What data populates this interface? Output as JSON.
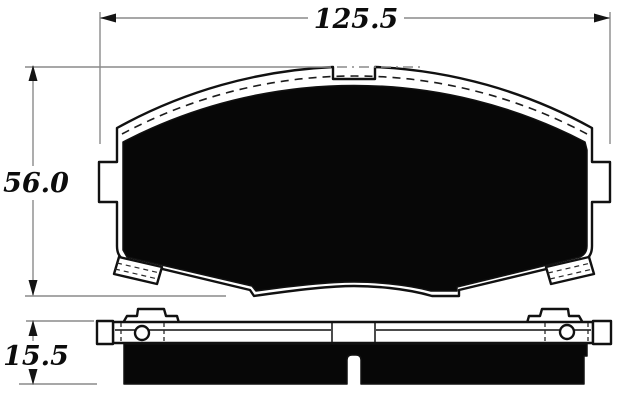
{
  "page": {
    "background_color": "#ffffff"
  },
  "drawing": {
    "kind": "brake-pad-dimensional-drawing",
    "outline_color": "#111111",
    "pad_fill_color": "#070707",
    "dimension_line_color": "#8a8a8a",
    "dimensions": {
      "overall_width": "125.5",
      "overall_height": "56.0",
      "pad_thickness": "15.5"
    }
  }
}
